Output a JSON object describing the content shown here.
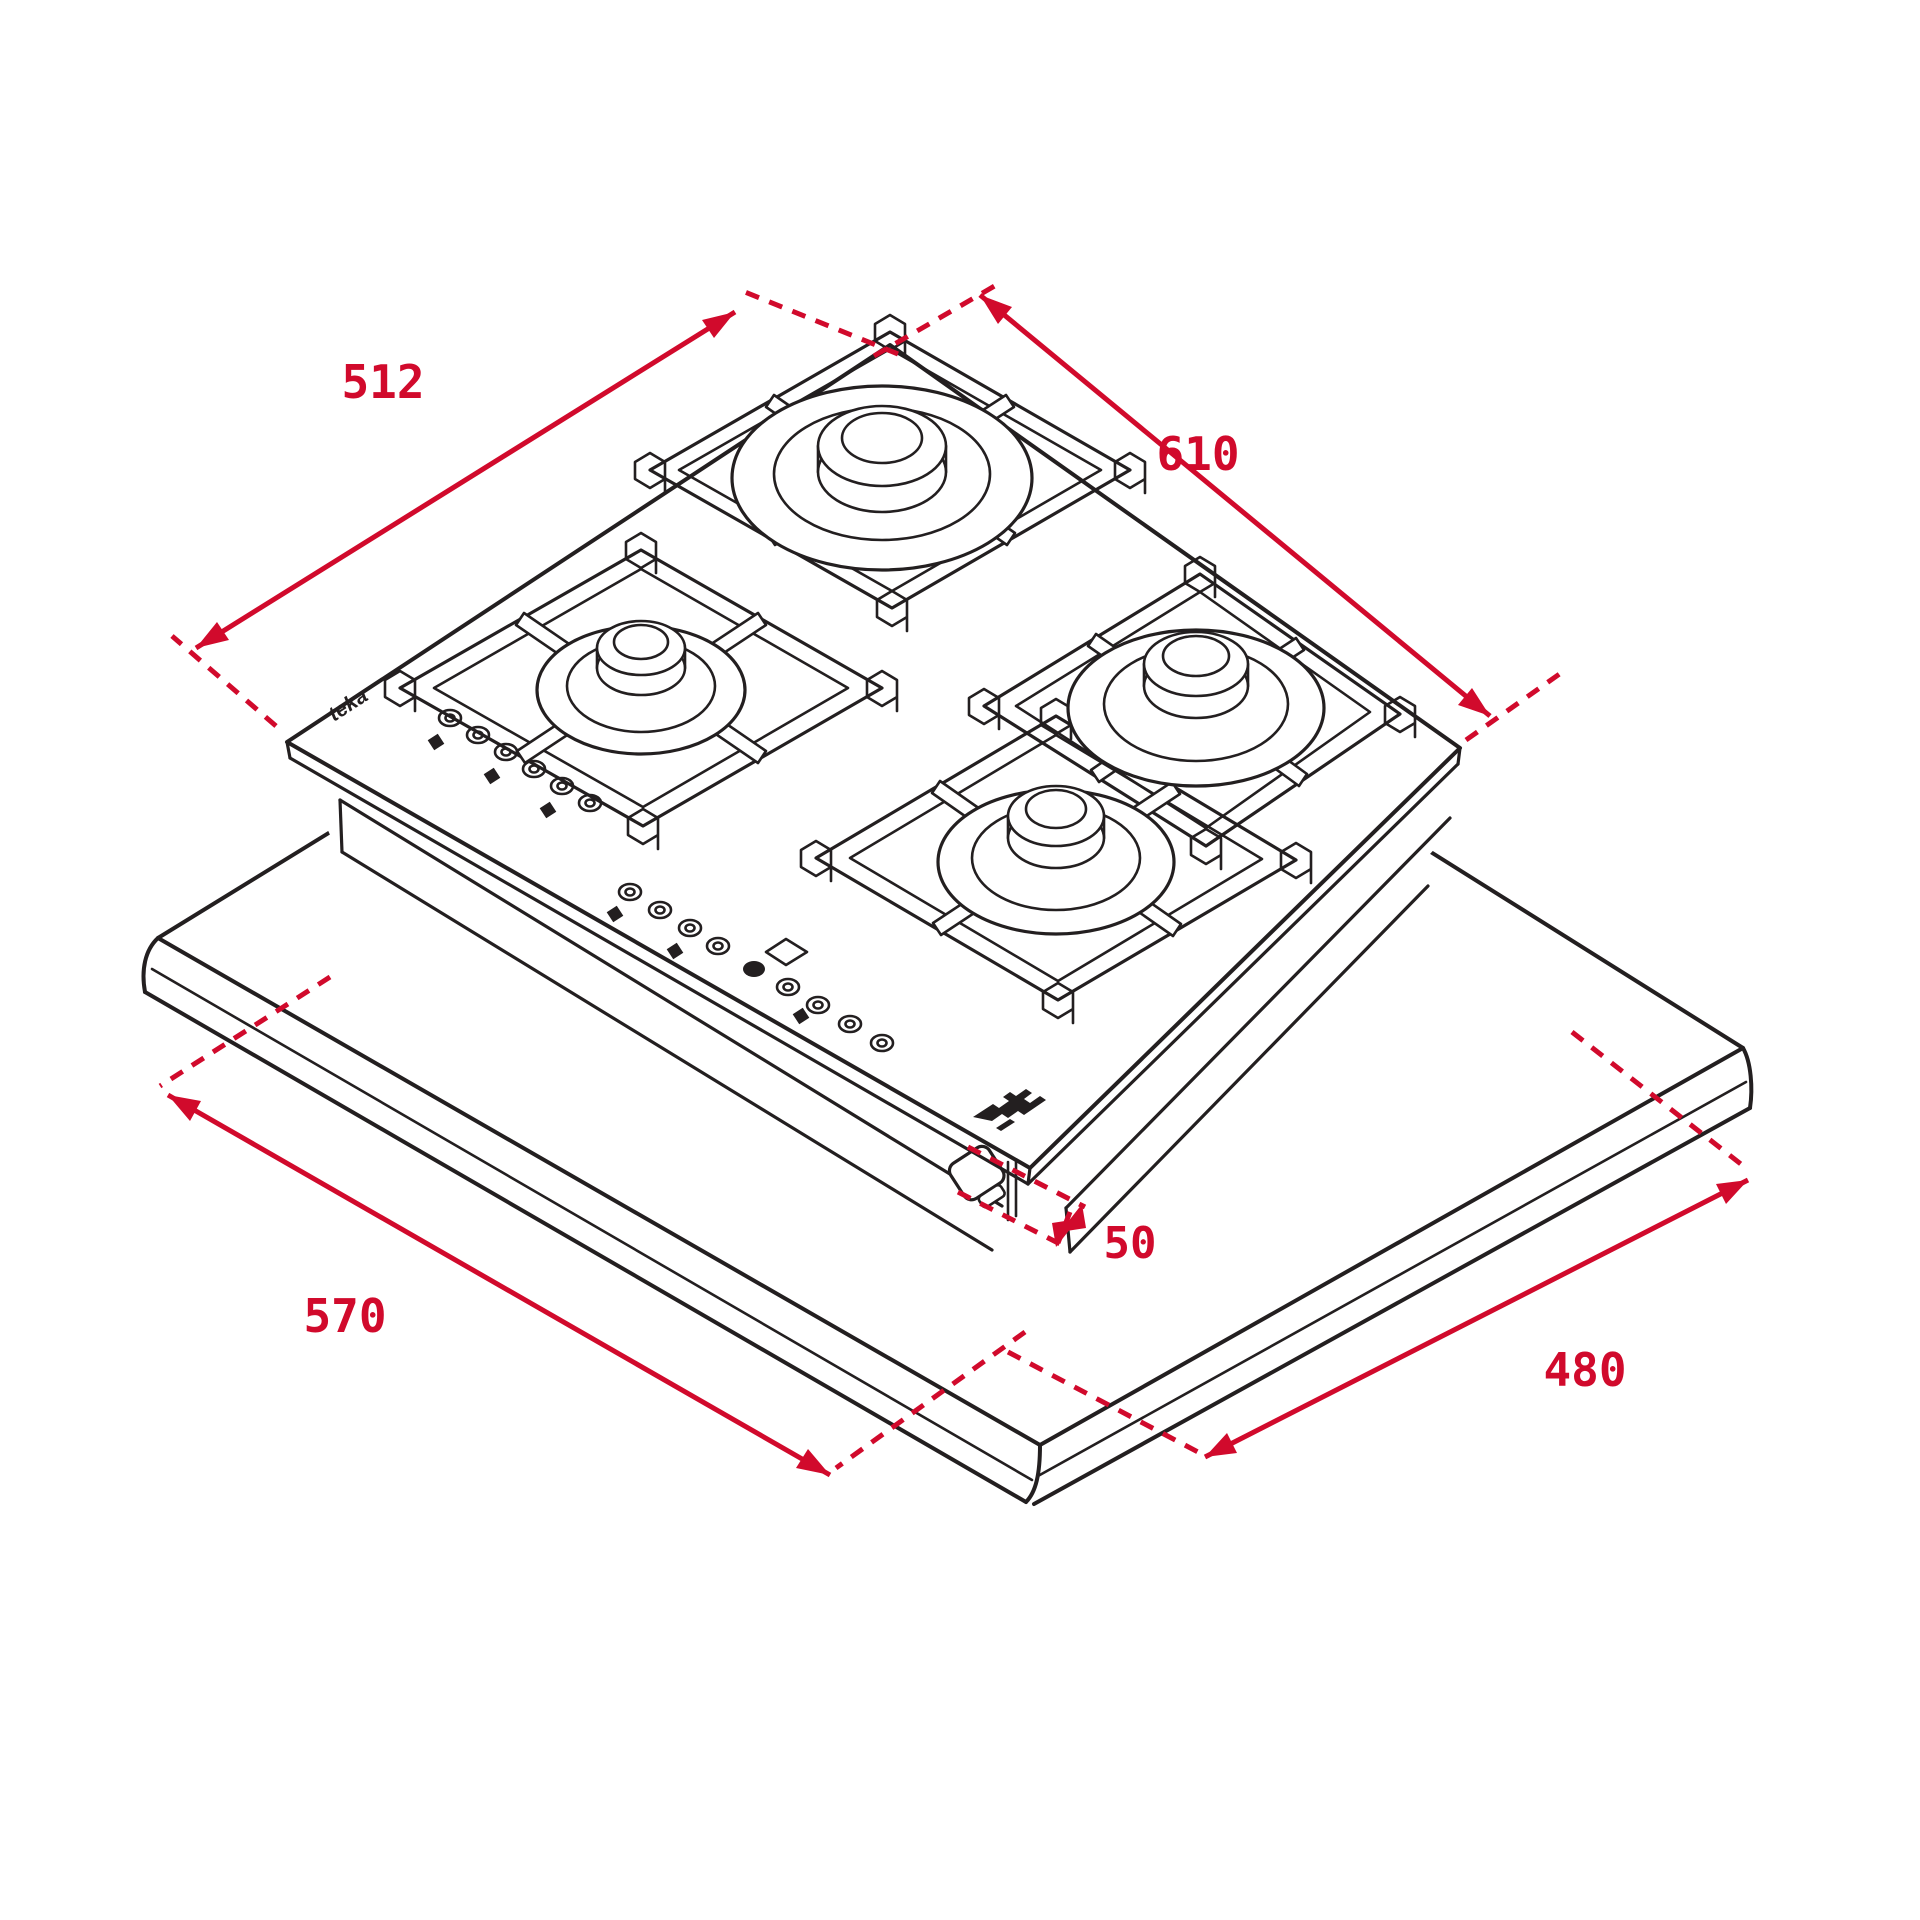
{
  "title": "Gas hob installation dimensions drawing",
  "colors": {
    "line": "#231f20",
    "accent": "#d10a2c",
    "background": "#ffffff"
  },
  "dimensions": {
    "hob_width": {
      "label": "610",
      "value": 610
    },
    "hob_depth": {
      "label": "512",
      "value": 512
    },
    "cutout_width": {
      "label": "570",
      "value": 570
    },
    "cutout_depth": {
      "label": "480",
      "value": 480
    },
    "clamp_offset": {
      "label": "50",
      "value": 50
    }
  },
  "branding": {
    "side_wordmark": "teka"
  },
  "drawing": {
    "type": "isometric-technical-line-drawing",
    "subject": "4-burner gas-on-glass hob mounted in worktop cutout",
    "features": [
      "pan support grids",
      "4 burners",
      "touch control strip",
      "display window",
      "mounting clamp",
      "worktop with rounded front edge"
    ]
  }
}
